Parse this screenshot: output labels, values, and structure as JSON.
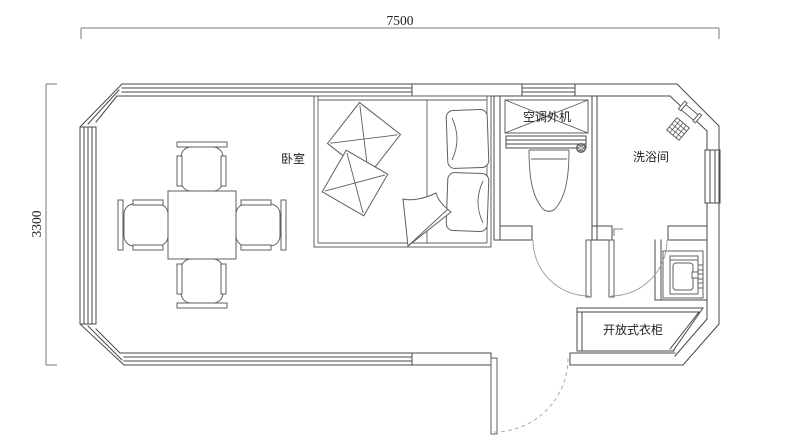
{
  "plan": {
    "type": "floor-plan",
    "dimensions": {
      "top": "7500",
      "left": "3300"
    },
    "labels": {
      "bedroom": "卧室",
      "ac_outdoor_unit": "空调外机",
      "bathroom": "洗浴间",
      "open_wardrobe": "开放式衣柜"
    },
    "fixtures": [
      "dining-table",
      "chair-top",
      "chair-bottom",
      "chair-left",
      "chair-right",
      "double-bed",
      "pillows",
      "decorative-cushions",
      "blanket-fold",
      "toilet",
      "floor-drain",
      "shower-head",
      "wash-basin",
      "ac-outdoor-unit",
      "open-wardrobe",
      "toilet-door",
      "bathroom-door",
      "entrance-door",
      "window-top",
      "window-left",
      "window-right",
      "window-bottom"
    ],
    "colors": {
      "background": "#ffffff",
      "wall_line": "#4a4a4a",
      "furniture_line": "#5f5f5f",
      "door_arc": "#9a9a9a",
      "dimension_line": "#7a7a7a",
      "text": "#1f1f1f"
    }
  }
}
